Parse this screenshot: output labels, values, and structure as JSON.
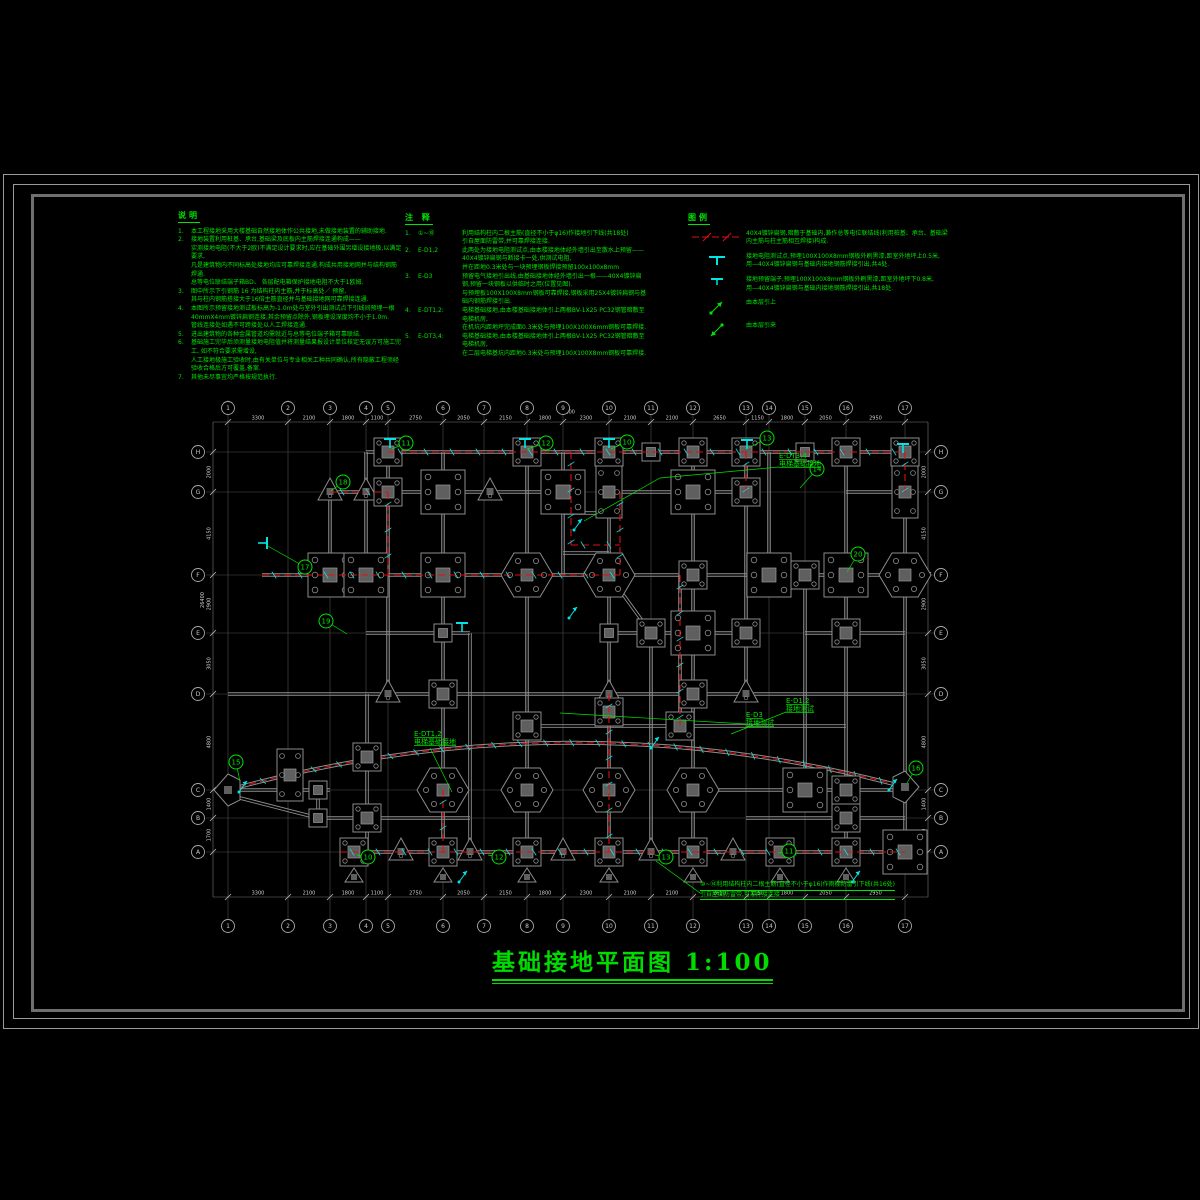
{
  "sheet": {
    "title": "基础接地平面图",
    "scale": "1:100"
  },
  "colors": {
    "green": "#00e400",
    "red": "#e01010",
    "cyan": "#00e5e5",
    "grid": "#4f4f4f",
    "beam": "#8f8f8f",
    "dim": "#cfcfcf",
    "bubble": "#a8a8a8"
  },
  "notes": {
    "title": "说明",
    "items": [
      {
        "num": "1.",
        "lines": [
          "本工程接地采用大楼基础自然接地体作公共接地,未做接地装置的辅助接地."
        ]
      },
      {
        "num": "2.",
        "lines": [
          "接地装置利用桩基、承台,基础梁及底板内主筋焊接连通构成——",
          "实测接地电阻(不大于2欧)不满足设计要求时,应在基础外围另增设接地极,以满足要求,",
          "凡是建筑物内不同标高处接地均应可靠焊接连通,构成共用接地网并与结构钢筋焊通.",
          "总等电位联结端子箱BD、 各层配电箱保护接地电阻不大于1欧姆."
        ]
      },
      {
        "num": "3.",
        "lines": [
          "图中所示下引钢筋 16 为结构柱内主筋,并于标高处／    预留,",
          "其与柱内钢筋搭接大于16倍主筋直径并与基础接地网可靠焊接连通."
        ]
      },
      {
        "num": "4.",
        "lines": [
          "本图所示预留接地测试板标高为-1.0m处与室外引出测试点下引线间预埋一根",
          "40mmX4mm镀锌扁钢连接,其余预留点除外,钢板埋设深度均不小于1.0m.",
          "管线连接处如遇不可跨接处以人工焊接连通."
        ]
      },
      {
        "num": "5.",
        "lines": [
          "进出建筑物的各种金属管道均需就近与总等电位端子箱可靠联结."
        ]
      },
      {
        "num": "6.",
        "lines": [
          "基础施工完毕后须测量接地电阻值并将测量结果报设计单位核定无误方可施工完工, 如不符合要求需增设,",
          "人工接地极施工验收时,由有关单位与专业相关工种共同确认,所有隐蔽工程须经验收合格后方可覆盖,备案."
        ]
      },
      {
        "num": "7.",
        "lines": [
          "其他未尽事宜均严格按规范执行."
        ]
      }
    ]
  },
  "annotations": {
    "title": "注 释",
    "items": [
      {
        "num": "1.",
        "code": "①~⑱",
        "lines": [
          "利用结构柱内二根主筋(直径不小于φ16)作接地引下线(共18处)",
          "引自屋面防雷带,并可靠焊接连接."
        ]
      },
      {
        "num": "2.",
        "code": "E-D1,2",
        "lines": [
          "此两处为接地电阻测试点,由本楼接地体经外墙引出至散水上预留——40X4镀锌扁钢与断接卡一处,供测试电阻,",
          "并在距地0.3米处与一块预埋钢板焊接预留100x100x8mm"
        ]
      },
      {
        "num": "3.",
        "code": "E-D3",
        "lines": [
          "预留电气接地引出线,由基础接地体经外墙引出一根——40X4镀锌扁钢,预留一块钢板以供临时之用(位置见图).",
          "与预埋板100X100X8mm钢板可靠焊接,钢板采用25X4镀锌扁钢与基础内钢筋焊接引出."
        ]
      },
      {
        "num": "4.",
        "code": "E-DT1,2:",
        "lines": [
          "电梯基础接地,由本楼基础接地体引上两根BV-1X25  PC32钢管暗敷至电梯机房,",
          "在机坑内距地坪完成面0.3米处与预埋100X100X6mm钢板可靠焊接."
        ]
      },
      {
        "num": "5.",
        "code": "E-DT3,4:",
        "lines": [
          "电梯基础接地,由本楼基础接地体引上两根BV-1X25  PC32钢管暗敷至电梯机房,",
          "在二层电梯基坑内距地0.3米处与预埋100X100X8mm钢板可靠焊接."
        ]
      }
    ]
  },
  "legend": {
    "title": "图例",
    "rows": [
      {
        "symbol": "ground-line",
        "lines": [
          "40X4镀锌扁钢,暗敷于基础内,兼作总等电位联结线(利用桩基、承台、基础梁内主筋与柱主筋相互焊接)构成."
        ]
      },
      {
        "symbol": "test-point",
        "lines": [
          "接地电阻测试点,预埋100X100X8mm钢板外刷黑漆,距室外地坪上0.5米,",
          "用—40X4镀锌扁钢与基础内接地钢筋焊接引出,共4处."
        ]
      },
      {
        "symbol": "reserve-point",
        "lines": [
          "接地预留端子,预埋100X100X8mm钢板外刷黑漆,距室外地坪下0.8米,",
          "用—40X4镀锌扁钢与基础内接地钢筋焊接引出,共18处."
        ]
      },
      {
        "symbol": "riser-up",
        "lines": [
          "由本层引上"
        ]
      },
      {
        "symbol": "riser-in",
        "lines": [
          "由本层引来"
        ]
      }
    ]
  },
  "plan": {
    "grid_x": [
      228,
      288,
      330,
      366,
      388,
      443,
      484,
      527,
      563,
      609,
      651,
      693,
      746,
      769,
      805,
      846,
      905
    ],
    "grid_y": [
      452,
      492,
      575,
      633,
      694,
      790,
      818,
      852
    ],
    "axis_top": [
      "1",
      "2",
      "3",
      "4",
      "5",
      "6",
      "7",
      "8",
      "9",
      "10",
      "11",
      "12",
      "13",
      "14",
      "15",
      "16",
      "17"
    ],
    "axis_side": [
      "H",
      "G",
      "F",
      "E",
      "D",
      "C",
      "B",
      "A"
    ],
    "dim_top": [
      "3300",
      "2100",
      "1800",
      "1100",
      "2750",
      "2050",
      "2150",
      "1800",
      "2300",
      "2100",
      "2100",
      "2650",
      "1150",
      "1800",
      "2050",
      "2950"
    ],
    "dim_bottom": [
      "3300",
      "2100",
      "1800",
      "1100",
      "2750",
      "2050",
      "2150",
      "1800",
      "2300",
      "2100",
      "2100",
      "2650",
      "1150",
      "1800",
      "2050",
      "2950"
    ],
    "dim_left": [
      "2000",
      "4150",
      "2900",
      "3050",
      "4800",
      "1400",
      "1700"
    ],
    "dim_right": [
      "2000",
      "4150",
      "2900",
      "3050",
      "4800",
      "1400",
      "1700"
    ],
    "overall_top": "74100",
    "overall_left": "26400",
    "beams_h": [
      {
        "y": 452,
        "x1": 366,
        "x2": 905
      },
      {
        "y": 492,
        "x1": 330,
        "x2": 563
      },
      {
        "y": 492,
        "x1": 609,
        "x2": 746
      },
      {
        "y": 492,
        "x1": 846,
        "x2": 905
      },
      {
        "y": 575,
        "x1": 262,
        "x2": 905
      },
      {
        "y": 633,
        "x1": 366,
        "x2": 470
      },
      {
        "y": 633,
        "x1": 609,
        "x2": 746
      },
      {
        "y": 633,
        "x1": 805,
        "x2": 905
      },
      {
        "y": 694,
        "x1": 228,
        "x2": 905
      },
      {
        "y": 726,
        "x1": 527,
        "x2": 846
      },
      {
        "y": 513,
        "x1": 563,
        "x2": 609
      },
      {
        "y": 553,
        "x1": 563,
        "x2": 609
      },
      {
        "y": 790,
        "x1": 228,
        "x2": 330
      },
      {
        "y": 790,
        "x1": 693,
        "x2": 905
      },
      {
        "y": 818,
        "x1": 318,
        "x2": 470
      },
      {
        "y": 818,
        "x1": 746,
        "x2": 905
      },
      {
        "y": 852,
        "x1": 340,
        "x2": 905
      }
    ],
    "beams_v": [
      {
        "x": 330,
        "y1": 492,
        "y2": 575
      },
      {
        "x": 366,
        "y1": 452,
        "y2": 575
      },
      {
        "x": 388,
        "y1": 452,
        "y2": 694
      },
      {
        "x": 443,
        "y1": 452,
        "y2": 852
      },
      {
        "x": 470,
        "y1": 633,
        "y2": 852
      },
      {
        "x": 527,
        "y1": 452,
        "y2": 852
      },
      {
        "x": 563,
        "y1": 452,
        "y2": 575
      },
      {
        "x": 609,
        "y1": 452,
        "y2": 852
      },
      {
        "x": 651,
        "y1": 633,
        "y2": 852
      },
      {
        "x": 693,
        "y1": 452,
        "y2": 852
      },
      {
        "x": 746,
        "y1": 452,
        "y2": 694
      },
      {
        "x": 769,
        "y1": 452,
        "y2": 575
      },
      {
        "x": 805,
        "y1": 575,
        "y2": 790
      },
      {
        "x": 846,
        "y1": 452,
        "y2": 852
      },
      {
        "x": 905,
        "y1": 452,
        "y2": 852
      },
      {
        "x": 680,
        "y1": 575,
        "y2": 726
      },
      {
        "x": 318,
        "y1": 790,
        "y2": 818
      },
      {
        "x": 367,
        "y1": 694,
        "y2": 852
      },
      {
        "x": 290,
        "y1": 752,
        "y2": 800
      }
    ],
    "beams_d": [
      {
        "x1": 609,
        "y1": 575,
        "x2": 651,
        "y2": 633
      },
      {
        "x1": 240,
        "y1": 798,
        "x2": 318,
        "y2": 818
      }
    ],
    "arc": {
      "x1": 228,
      "y1": 790,
      "qx": 567,
      "qy": 697,
      "x2": 905,
      "y2": 787
    },
    "columns": [
      {
        "x": 388,
        "y": 452,
        "t": "m"
      },
      {
        "x": 527,
        "y": 452,
        "t": "m"
      },
      {
        "x": 609,
        "y": 452,
        "t": "m"
      },
      {
        "x": 651,
        "y": 452,
        "t": "s"
      },
      {
        "x": 693,
        "y": 452,
        "t": "m"
      },
      {
        "x": 746,
        "y": 452,
        "t": "m"
      },
      {
        "x": 805,
        "y": 452,
        "t": "s"
      },
      {
        "x": 846,
        "y": 452,
        "t": "m"
      },
      {
        "x": 905,
        "y": 452,
        "t": "m"
      },
      {
        "x": 330,
        "y": 492,
        "t": "t"
      },
      {
        "x": 366,
        "y": 492,
        "t": "t"
      },
      {
        "x": 388,
        "y": 492,
        "t": "m"
      },
      {
        "x": 443,
        "y": 492,
        "t": "l"
      },
      {
        "x": 490,
        "y": 492,
        "t": "t"
      },
      {
        "x": 563,
        "y": 492,
        "t": "l"
      },
      {
        "x": 609,
        "y": 492,
        "t": "r2"
      },
      {
        "x": 693,
        "y": 492,
        "t": "l"
      },
      {
        "x": 746,
        "y": 492,
        "t": "m"
      },
      {
        "x": 905,
        "y": 492,
        "t": "r2"
      },
      {
        "x": 330,
        "y": 575,
        "t": "l"
      },
      {
        "x": 366,
        "y": 575,
        "t": "l"
      },
      {
        "x": 443,
        "y": 575,
        "t": "l"
      },
      {
        "x": 527,
        "y": 575,
        "t": "h"
      },
      {
        "x": 609,
        "y": 575,
        "t": "h"
      },
      {
        "x": 693,
        "y": 575,
        "t": "m"
      },
      {
        "x": 769,
        "y": 575,
        "t": "l"
      },
      {
        "x": 805,
        "y": 575,
        "t": "m"
      },
      {
        "x": 846,
        "y": 575,
        "t": "l"
      },
      {
        "x": 905,
        "y": 575,
        "t": "h"
      },
      {
        "x": 443,
        "y": 633,
        "t": "s"
      },
      {
        "x": 609,
        "y": 633,
        "t": "s"
      },
      {
        "x": 651,
        "y": 633,
        "t": "m"
      },
      {
        "x": 693,
        "y": 633,
        "t": "l"
      },
      {
        "x": 746,
        "y": 633,
        "t": "m"
      },
      {
        "x": 846,
        "y": 633,
        "t": "m"
      },
      {
        "x": 388,
        "y": 694,
        "t": "t"
      },
      {
        "x": 443,
        "y": 694,
        "t": "m"
      },
      {
        "x": 609,
        "y": 694,
        "t": "t"
      },
      {
        "x": 693,
        "y": 694,
        "t": "m"
      },
      {
        "x": 746,
        "y": 694,
        "t": "t"
      },
      {
        "x": 527,
        "y": 726,
        "t": "m"
      },
      {
        "x": 609,
        "y": 712,
        "t": "m"
      },
      {
        "x": 680,
        "y": 726,
        "t": "m"
      },
      {
        "x": 290,
        "y": 775,
        "t": "r2"
      },
      {
        "x": 367,
        "y": 757,
        "t": "m"
      },
      {
        "x": 318,
        "y": 790,
        "t": "s"
      },
      {
        "x": 443,
        "y": 790,
        "t": "h"
      },
      {
        "x": 527,
        "y": 790,
        "t": "h"
      },
      {
        "x": 609,
        "y": 790,
        "t": "h"
      },
      {
        "x": 693,
        "y": 790,
        "t": "h"
      },
      {
        "x": 805,
        "y": 790,
        "t": "l"
      },
      {
        "x": 846,
        "y": 790,
        "t": "m"
      },
      {
        "x": 318,
        "y": 818,
        "t": "s"
      },
      {
        "x": 367,
        "y": 818,
        "t": "m"
      },
      {
        "x": 846,
        "y": 818,
        "t": "m"
      },
      {
        "x": 354,
        "y": 852,
        "t": "mt"
      },
      {
        "x": 401,
        "y": 852,
        "t": "t"
      },
      {
        "x": 443,
        "y": 852,
        "t": "mt"
      },
      {
        "x": 470,
        "y": 852,
        "t": "t"
      },
      {
        "x": 527,
        "y": 852,
        "t": "mt"
      },
      {
        "x": 563,
        "y": 852,
        "t": "t"
      },
      {
        "x": 609,
        "y": 852,
        "t": "mt"
      },
      {
        "x": 651,
        "y": 852,
        "t": "t"
      },
      {
        "x": 693,
        "y": 852,
        "t": "mt"
      },
      {
        "x": 733,
        "y": 852,
        "t": "t"
      },
      {
        "x": 780,
        "y": 852,
        "t": "mt"
      },
      {
        "x": 846,
        "y": 852,
        "t": "mt"
      },
      {
        "x": 905,
        "y": 852,
        "t": "l"
      }
    ],
    "arrows_end": [
      {
        "x": 228,
        "y": 790,
        "dir": "L"
      },
      {
        "x": 905,
        "y": 787,
        "dir": "R"
      }
    ],
    "ground_paths": [
      [
        [
          388,
          452
        ],
        [
          905,
          452
        ]
      ],
      [
        [
          262,
          575
        ],
        [
          620,
          575
        ]
      ],
      [
        [
          330,
          492
        ],
        [
          388,
          492
        ],
        [
          388,
          575
        ]
      ],
      [
        [
          571,
          452
        ],
        [
          571,
          545
        ],
        [
          620,
          545
        ]
      ],
      [
        [
          620,
          492
        ],
        [
          620,
          575
        ]
      ],
      [
        [
          680,
          575
        ],
        [
          680,
          726
        ]
      ],
      [
        [
          746,
          452
        ],
        [
          746,
          492
        ]
      ],
      [
        [
          905,
          452
        ],
        [
          905,
          492
        ]
      ],
      [
        [
          340,
          852
        ],
        [
          905,
          852
        ]
      ],
      [
        [
          609,
          694
        ],
        [
          609,
          852
        ]
      ],
      [
        [
          443,
          790
        ],
        [
          443,
          852
        ]
      ]
    ],
    "test_points": [
      {
        "x": 390,
        "y": 444,
        "r": 0
      },
      {
        "x": 525,
        "y": 444,
        "r": 0
      },
      {
        "x": 609,
        "y": 444,
        "r": 0
      },
      {
        "x": 747,
        "y": 445,
        "r": 0
      },
      {
        "x": 903,
        "y": 449,
        "r": 0
      },
      {
        "x": 262,
        "y": 543,
        "r": 90
      },
      {
        "x": 462,
        "y": 628,
        "r": 0
      }
    ],
    "risers": [
      {
        "x": 578,
        "y": 524
      },
      {
        "x": 655,
        "y": 742
      },
      {
        "x": 463,
        "y": 876
      },
      {
        "x": 856,
        "y": 876
      },
      {
        "x": 573,
        "y": 612
      },
      {
        "x": 243,
        "y": 786
      },
      {
        "x": 893,
        "y": 784
      }
    ],
    "callouts": [
      {
        "n": "18",
        "x": 343,
        "y": 482,
        "lx": 331,
        "ly": 491
      },
      {
        "n": "17",
        "x": 305,
        "y": 567,
        "lx": 266,
        "ly": 545
      },
      {
        "n": "11",
        "x": 406,
        "y": 443,
        "lx": 392,
        "ly": 449
      },
      {
        "n": "12",
        "x": 546,
        "y": 443,
        "lx": 527,
        "ly": 449
      },
      {
        "n": "10",
        "x": 627,
        "y": 442,
        "lx": 611,
        "ly": 449
      },
      {
        "n": "13",
        "x": 767,
        "y": 438,
        "lx": 749,
        "ly": 448
      },
      {
        "n": "14",
        "x": 817,
        "y": 469,
        "lx": 800,
        "ly": 488
      },
      {
        "n": "20",
        "x": 858,
        "y": 554,
        "lx": 847,
        "ly": 572
      },
      {
        "n": "19",
        "x": 326,
        "y": 621,
        "lx": 347,
        "ly": 634
      },
      {
        "n": "15",
        "x": 236,
        "y": 762,
        "lx": 240,
        "ly": 782
      },
      {
        "n": "16",
        "x": 916,
        "y": 768,
        "lx": 907,
        "ly": 783
      },
      {
        "n": "10",
        "x": 368,
        "y": 857,
        "lx": 357,
        "ly": 855
      },
      {
        "n": "12",
        "x": 499,
        "y": 857,
        "lx": 488,
        "ly": 855
      },
      {
        "n": "13",
        "x": 666,
        "y": 857,
        "lx": 655,
        "ly": 855
      },
      {
        "n": "11",
        "x": 789,
        "y": 851,
        "lx": 778,
        "ly": 853
      }
    ],
    "labels": [
      {
        "x": 779,
        "y": 458,
        "lines": [
          "E-DT3,4",
          "电梯基础接地"
        ],
        "leader": [
          [
            779,
            467
          ],
          [
            660,
            478
          ],
          [
            584,
            521
          ]
        ]
      },
      {
        "x": 414,
        "y": 736,
        "lines": [
          "E-DT1,2",
          "电梯基础接地"
        ],
        "leader": [
          [
            430,
            748
          ],
          [
            441,
            770
          ],
          [
            452,
            792
          ]
        ]
      },
      {
        "x": 786,
        "y": 703,
        "lines": [
          "E-D1,2",
          "接地测试"
        ],
        "leader": [
          [
            786,
            712
          ],
          [
            731,
            734
          ]
        ]
      },
      {
        "x": 746,
        "y": 717,
        "lines": [
          "E-D3",
          "接地测试"
        ],
        "leader": [
          [
            746,
            724
          ],
          [
            560,
            713
          ]
        ]
      }
    ],
    "site_note_leader": [
      [
        700,
        893
      ],
      [
        656,
        861
      ]
    ]
  },
  "site_note": {
    "lines": [
      "⑩~⑭利用结构柱内二根主筋(直径不小于φ16)作雨棚防雷引下线(共16处)",
      "引自屋面防雷带,可靠焊接连接"
    ]
  }
}
